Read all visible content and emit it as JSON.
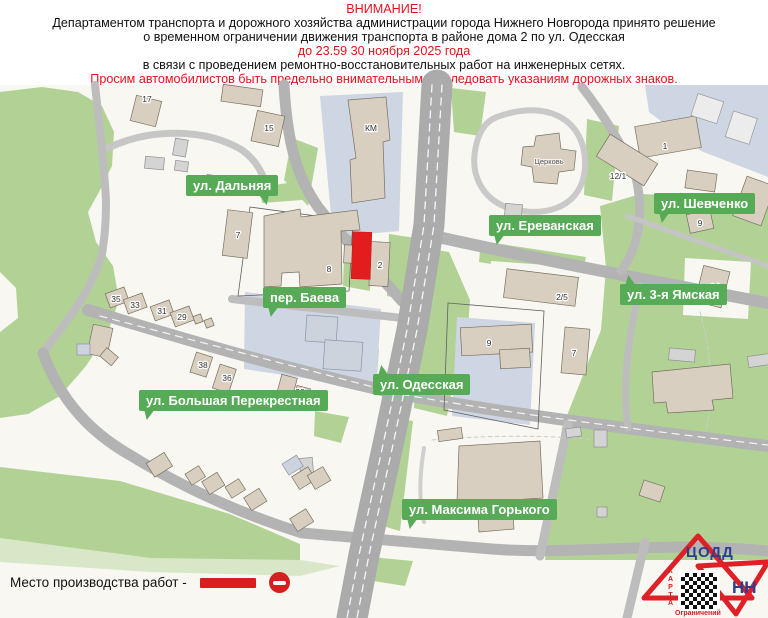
{
  "header": {
    "line1": "ВНИМАНИЕ!",
    "line2": "Департаментом транспорта и дорожного хозяйства администрации города Нижнего Новгорода принято решение",
    "line3": "о временном ограничении движения транспорта в районе дома 2 по ул. Одесская",
    "line4": "до 23.59 30 ноября 2025 года",
    "line5": "в связи с проведением ремонтно-восстановительных работ на инженерных сетях.",
    "line6": "Просим автомобилистов быть предельно внимательными и следовать указаниям дорожных знаков."
  },
  "map": {
    "street_labels": [
      {
        "text": "ул. Дальняя"
      },
      {
        "text": "ул. Ереванская"
      },
      {
        "text": "ул. Шевченко"
      },
      {
        "text": "пер. Баева"
      },
      {
        "text": "ул. 3-я Ямская"
      },
      {
        "text": "ул. Одесская"
      },
      {
        "text": "ул. Большая Перекрестная"
      },
      {
        "text": "ул. Максима Горького"
      }
    ],
    "building_labels": [
      "17",
      "15",
      "КМ",
      "7",
      "8",
      "2",
      "Церковь",
      "12/1",
      "1",
      "9",
      "2/5",
      "14",
      "9",
      "7",
      "35",
      "33",
      "31",
      "29",
      "38",
      "36",
      "28"
    ],
    "marker_color": "#e31d1d",
    "street_label_green": "#57ab57"
  },
  "legend": {
    "label": "Место производства работ -"
  },
  "logo": {
    "org": "ЦОДД",
    "city": "НН",
    "side": "КАРТА",
    "bottom": "Ограничений"
  },
  "colors": {
    "accent_red": "#e8121c",
    "road_gray": "#b3b3b3",
    "park_green": "#b2d295"
  }
}
